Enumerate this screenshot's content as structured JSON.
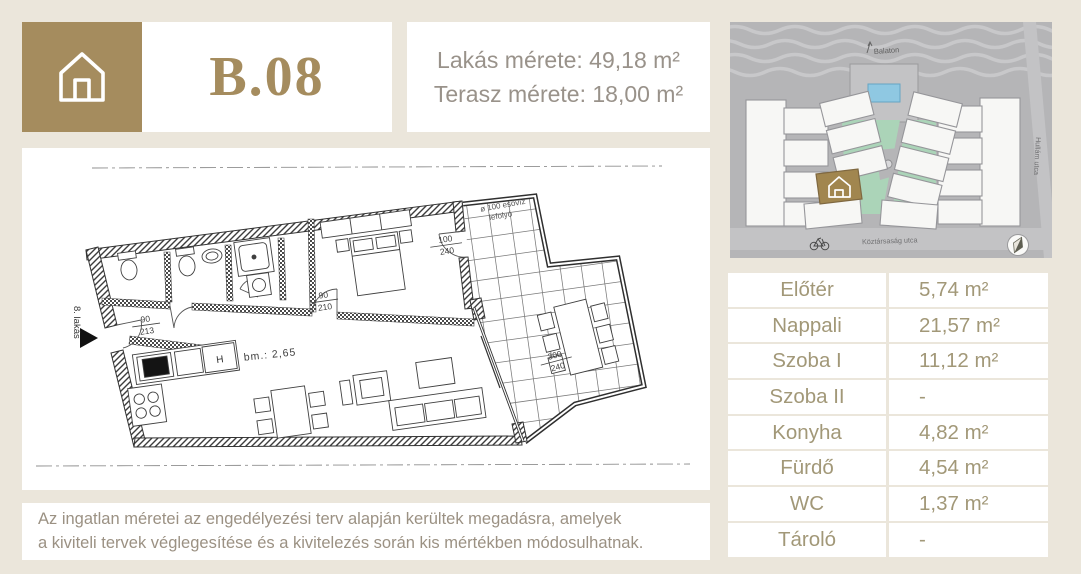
{
  "header": {
    "unit_code": "B.08",
    "apartment_size": "Lakás mérete: 49,18 m²",
    "terrace_size": "Terasz mérete: 18,00 m²"
  },
  "site_map": {
    "balaton_label": "Balaton",
    "street_bottom": "Köztársaság utca",
    "street_right": "Hullám utca"
  },
  "floor_plan": {
    "entrance_label": "8. lakás",
    "ceiling_height": "bm.: 2,65",
    "drain_line1": "ø 100 esővíz",
    "drain_line2": "lefolyó",
    "fridge_label": "H",
    "door_dims": [
      {
        "w": "90",
        "h": "213"
      },
      {
        "w": "90",
        "h": "210"
      },
      {
        "w": "100",
        "h": "240"
      },
      {
        "w": "300",
        "h": "240"
      }
    ]
  },
  "rooms": [
    {
      "name": "Előtér",
      "area": "5,74 m²"
    },
    {
      "name": "Nappali",
      "area": "21,57 m²"
    },
    {
      "name": "Szoba I",
      "area": "11,12 m²"
    },
    {
      "name": "Szoba II",
      "area": "-"
    },
    {
      "name": "Konyha",
      "area": "4,82 m²"
    },
    {
      "name": "Fürdő",
      "area": "4,54 m²"
    },
    {
      "name": "WC",
      "area": "1,37 m²"
    },
    {
      "name": "Tároló",
      "area": "-"
    }
  ],
  "disclaimer": {
    "line1": "Az ingatlan méretei az engedélyezési terv alapján kerültek megadásra, amelyek",
    "line2": "a kiviteli tervek véglegesítése és a kivitelezés során kis mértékben módosulhatnak."
  },
  "colors": {
    "gold": "#a58c5e",
    "page_bg": "#ebe6db",
    "map_gray": "#b5b5b7",
    "green": "#abd4b8",
    "pool_blue": "#8fc8e2"
  }
}
